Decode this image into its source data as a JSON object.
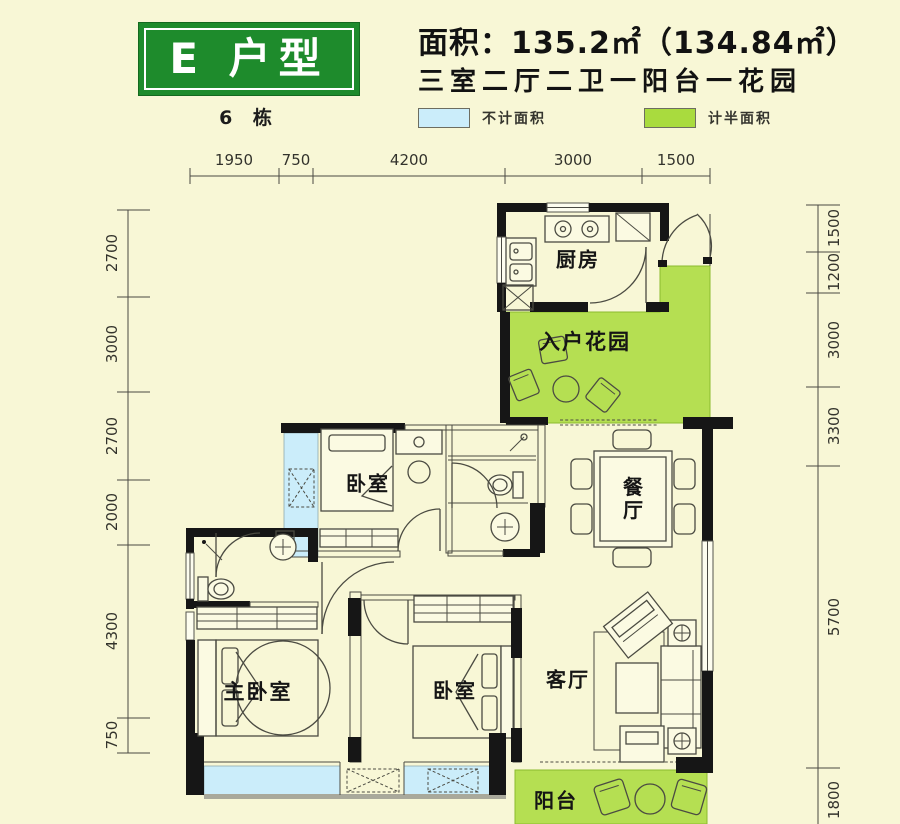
{
  "header": {
    "badge": "E 户型",
    "building": "6 栋",
    "area_line": "面积：135.2㎡（134.84㎡）",
    "layout_line": "三室二厅二卫一阳台一花园",
    "legend": [
      {
        "label": "不计面积",
        "color": "#CBEDFA"
      },
      {
        "label": "计半面积",
        "color": "#A9DB3E"
      }
    ]
  },
  "dimensions": {
    "top": [
      "1950",
      "750",
      "4200",
      "3000",
      "1500"
    ],
    "left": [
      "2700",
      "3000",
      "2700",
      "2000",
      "4300",
      "750"
    ],
    "right": [
      "1500",
      "1200",
      "3000",
      "3300",
      "5700",
      "1800"
    ]
  },
  "rooms": {
    "kitchen": "厨房",
    "entry_garden": "入户花园",
    "dining": "餐厅",
    "bedroom_top": "卧室",
    "master_bedroom": "主卧室",
    "bedroom_second": "卧室",
    "living": "客厅",
    "balcony": "阳台"
  },
  "colors": {
    "background": "#F8F7D6",
    "badge_green": "#1E8B2C",
    "half_area_green": "#B5DF52",
    "excluded_blue": "#CBEDFA",
    "wall": "#161616"
  }
}
